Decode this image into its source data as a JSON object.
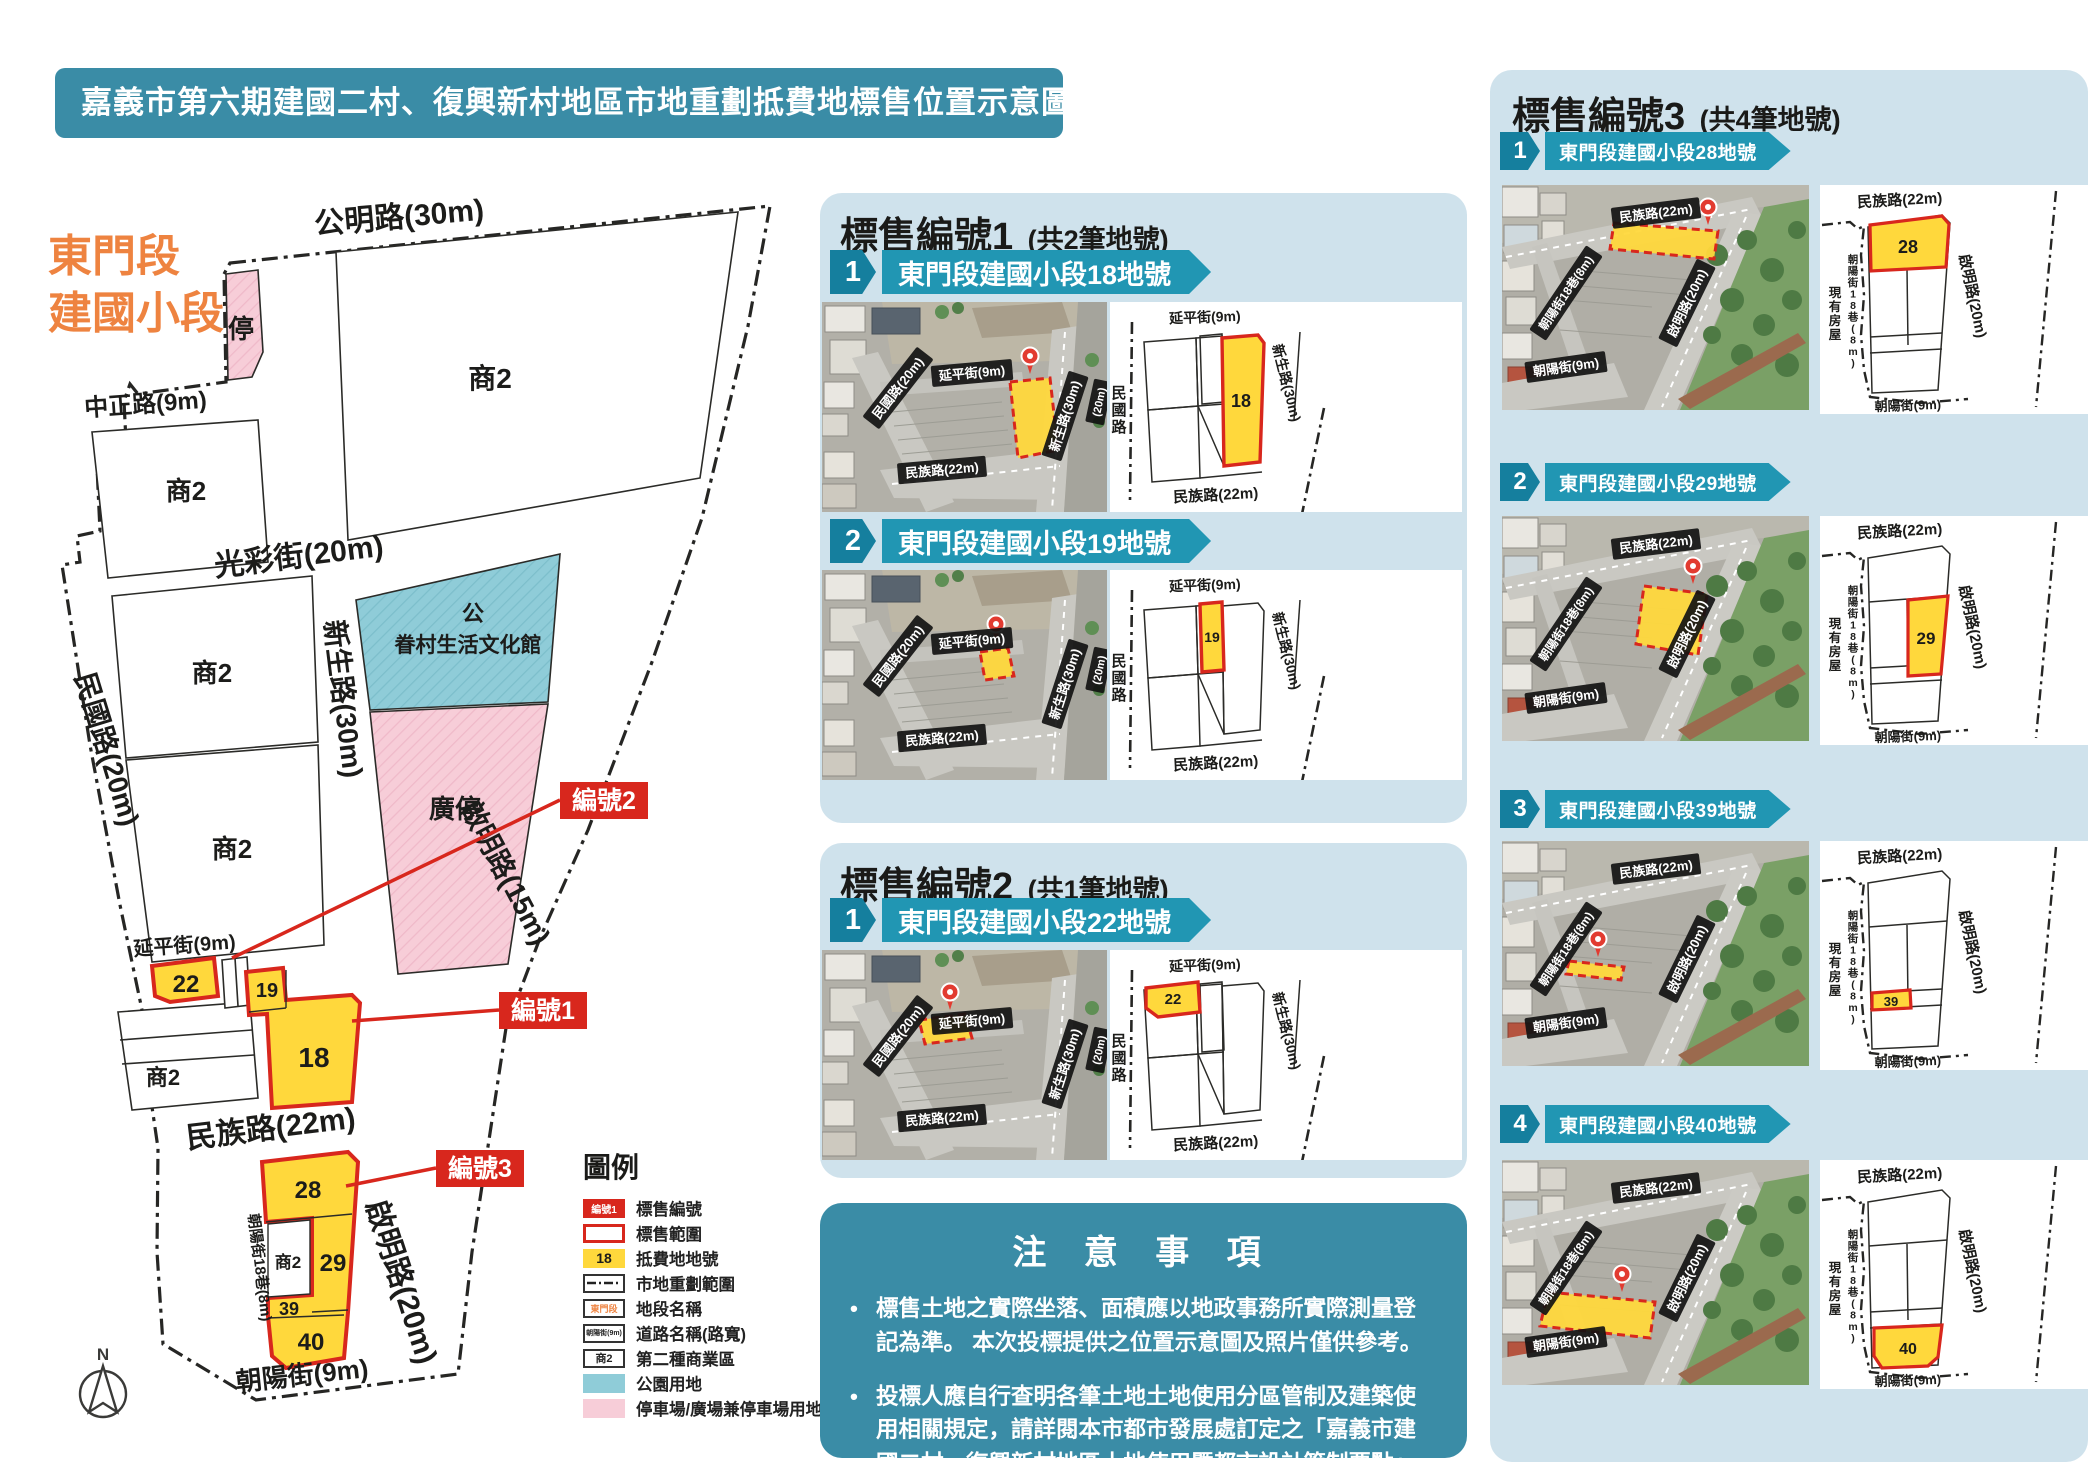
{
  "title": "嘉義市第六期建國二村、復興新村地區市地重劃抵費地標售位置示意圖",
  "colors": {
    "teal": "#3a8ca6",
    "panel_blue": "#cfe2ec",
    "ribbon": "#2196b3",
    "ribbon_dark": "#157f9e",
    "yellow": "#ffd83c",
    "red": "#d8271d",
    "orange": "#ee8340",
    "park_blue": "#8fccd8",
    "pink": "#f7cdd8"
  },
  "map": {
    "section_label_line1": "東門段",
    "section_label_line2": "建國小段",
    "compass": "N",
    "roads": {
      "gongming": "公明路(30m)",
      "zhongzheng": "中正路(9m)",
      "guangcai": "光彩街(20m)",
      "xinsheng": "新生路(30m)",
      "minguo": "民國路(20m)",
      "qiming15": "啟明路(15m)",
      "yanping": "延平街(9m)",
      "minzu": "民族路(22m)",
      "chaoyang_lane": "朝陽街18巷(8m)",
      "qiming20": "啟明路(20m)",
      "chaoyang": "朝陽街(9m)"
    },
    "zones": {
      "parking_strip": "停",
      "shang2": "商2",
      "park_line1": "公",
      "park_line2": "眷村生活文化館",
      "plaza": "廣停"
    },
    "plots": {
      "p18": "18",
      "p19": "19",
      "p22": "22",
      "p28": "28",
      "p29": "29",
      "p39": "39",
      "p40": "40"
    },
    "callouts": {
      "c1": "編號1",
      "c2": "編號2",
      "c3": "編號3"
    }
  },
  "legend": {
    "title": "圖例",
    "items": [
      {
        "type": "badge",
        "swatch_text": "編號1",
        "label": "標售編號"
      },
      {
        "type": "outline_red",
        "swatch_text": "",
        "label": "標售範圍"
      },
      {
        "type": "yellow_tag",
        "swatch_text": "18",
        "label": "抵費地地號"
      },
      {
        "type": "dash_line",
        "swatch_text": "",
        "label": "市地重劃範圍"
      },
      {
        "type": "box_orange",
        "swatch_text": "東門段",
        "label": "地段名稱"
      },
      {
        "type": "box_road",
        "swatch_text": "朝陽街(9m)",
        "label": "道路名稱(路寬)"
      },
      {
        "type": "box_shang",
        "swatch_text": "商2",
        "label": "第二種商業區"
      },
      {
        "type": "fill_blue",
        "swatch_text": "",
        "label": "公園用地"
      },
      {
        "type": "fill_pink",
        "swatch_text": "",
        "label": "停車場/廣場兼停車場用地"
      }
    ]
  },
  "sections": [
    {
      "heading": "標售編號1",
      "heading_sub": "(共2筆地號)",
      "column": "mid",
      "items": [
        {
          "num": "1",
          "label": "東門段建國小段18地號",
          "plot": "18",
          "photo_labels": {
            "left_road": "民國路(20m)",
            "top_road": "延平街(9m)",
            "right_road": "新生路(30m)",
            "bottom_road": "民族路(22m)",
            "edge_road": "(20m)"
          },
          "diagram_labels": {
            "top": "延平街(9m)",
            "left": "民國路",
            "right": "新生路(30m)",
            "bottom": "民族路(22m)"
          }
        },
        {
          "num": "2",
          "label": "東門段建國小段19地號",
          "plot": "19",
          "photo_labels": {
            "left_road": "民國路(20m)",
            "top_road": "延平街(9m)",
            "right_road": "新生路(30m)",
            "bottom_road": "民族路(22m)",
            "edge_road": "(20m)"
          },
          "diagram_labels": {
            "top": "延平街(9m)",
            "left": "民國路",
            "right": "新生路(30m)",
            "bottom": "民族路(22m)"
          }
        }
      ]
    },
    {
      "heading": "標售編號2",
      "heading_sub": "(共1筆地號)",
      "column": "mid",
      "items": [
        {
          "num": "1",
          "label": "東門段建國小段22地號",
          "plot": "22",
          "photo_labels": {
            "left_road": "民國路(20m)",
            "top_road": "延平街(9m)",
            "right_road": "新生路(30m)",
            "bottom_road": "民族路(22m)",
            "edge_road": "(20m)"
          },
          "diagram_labels": {
            "top": "延平街(9m)",
            "left": "民國路",
            "right": "新生路(30m)",
            "bottom": "民族路(22m)"
          }
        }
      ]
    },
    {
      "heading": "標售編號3",
      "heading_sub": "(共4筆地號)",
      "column": "right",
      "items": [
        {
          "num": "1",
          "label": "東門段建國小段28地號",
          "plot": "28",
          "photo_labels": {
            "top_road": "民族路(22m)",
            "left_road": "朝陽街18巷(8m)",
            "mid_road": "啟明路(20m)",
            "bottom_road": "朝陽街(9m)"
          },
          "diagram_labels": {
            "top": "民族路(22m)",
            "right": "啟明路(20m)",
            "left_lane": "朝陽街18巷(8m)",
            "left_note": "現有房屋",
            "bottom": "朝陽街(9m)"
          }
        },
        {
          "num": "2",
          "label": "東門段建國小段29地號",
          "plot": "29",
          "photo_labels": {
            "top_road": "民族路(22m)",
            "left_road": "朝陽街18巷(8m)",
            "mid_road": "啟明路(20m)",
            "bottom_road": "朝陽街(9m)"
          },
          "diagram_labels": {
            "top": "民族路(22m)",
            "right": "啟明路(20m)",
            "left_lane": "朝陽街18巷(8m)",
            "left_note": "現有房屋",
            "bottom": "朝陽街(9m)"
          }
        },
        {
          "num": "3",
          "label": "東門段建國小段39地號",
          "plot": "39",
          "photo_labels": {
            "top_road": "民族路(22m)",
            "left_road": "朝陽街18巷(8m)",
            "mid_road": "啟明路(20m)",
            "bottom_road": "朝陽街(9m)"
          },
          "diagram_labels": {
            "top": "民族路(22m)",
            "right": "啟明路(20m)",
            "left_lane": "朝陽街18巷(8m)",
            "left_note": "現有房屋",
            "bottom": "朝陽街(9m)"
          }
        },
        {
          "num": "4",
          "label": "東門段建國小段40地號",
          "plot": "40",
          "photo_labels": {
            "top_road": "民族路(22m)",
            "left_road": "朝陽街18巷(8m)",
            "mid_road": "啟明路(20m)",
            "bottom_road": "朝陽街(9m)"
          },
          "diagram_labels": {
            "top": "民族路(22m)",
            "right": "啟明路(20m)",
            "left_lane": "朝陽街18巷(8m)",
            "left_note": "現有房屋",
            "bottom": "朝陽街(9m)"
          }
        }
      ]
    }
  ],
  "notes": {
    "title": "注 意 事 項",
    "bullets": [
      "標售土地之實際坐落、面積應以地政事務所實際測量登記為準。 本次投標提供之位置示意圖及照片僅供參考。",
      "投標人應自行查明各筆土地土地使用分區管制及建築使用相關規定，請詳閱本市都市發展處訂定之「嘉義市建國二村、復興新村地區土地使用暨都市設計管制要點」。"
    ]
  }
}
